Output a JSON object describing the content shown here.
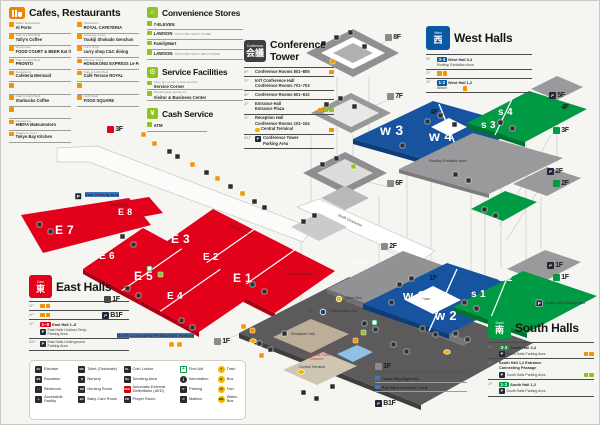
{
  "cafes": {
    "title": "Cafes, Restaurants",
    "floor_tag": "3F",
    "col1": [
      {
        "cat": "Italian Restaurant",
        "name": "Al Porto"
      },
      {
        "cat": "Cafe & Light Meal",
        "name": "Tully's Coffee"
      },
      {
        "cat": "Food Court",
        "name": "FOOD COURT & BEER Eat iT!"
      },
      {
        "cat": "Cafe & Light Meal",
        "name": "PRONTO"
      },
      {
        "cat": "Restaurant",
        "name": "Cafeteria Mermaid"
      },
      {
        "cat": "",
        "name": ""
      },
      {
        "cat": "Cafe & Light Meal",
        "name": "Starbucks Coffee"
      },
      {
        "cat": "",
        "name": ""
      },
      {
        "cat": "Restaurant",
        "name": "HIBIYA Matsumotoro"
      },
      {
        "cat": "Japanese Food",
        "name": "Tokyo Bay Kitchen"
      }
    ],
    "col2": [
      {
        "cat": "Restaurant",
        "name": "ROYAL CAFETERIA"
      },
      {
        "cat": "Japanese Food",
        "name": "Tsukiji Shokado Genchan"
      },
      {
        "cat": "Curry Shop",
        "name": "curry shop C&C dining"
      },
      {
        "cat": "Chinese Food",
        "name": "HONGKONG EXPRESS Le PARC"
      },
      {
        "cat": "Cafe & Light Meal",
        "name": "Café Terrace ROYAL"
      },
      {
        "cat": "",
        "name": ""
      },
      {
        "cat": "Light Meal",
        "name": "FOOD SQUARE"
      }
    ]
  },
  "convenience": {
    "title": "Convenience Stores",
    "items": [
      {
        "name": "7-ELEVEN",
        "note": ""
      },
      {
        "name": "LAWSON",
        "note": "TOKYO BIG SIGHT STORE"
      },
      {
        "name": "FamilyMart",
        "note": ""
      },
      {
        "name": "LAWSON",
        "note": "TOKYO BIG SIGHT WEST STORE"
      }
    ]
  },
  "service": {
    "title": "Service Facilities",
    "items": [
      {
        "note": "Copy, fax, courier & other services",
        "name": "Service Corner"
      },
      {
        "note": "Prepaid cards, goods, etc.",
        "name": "Visitor & Business Center"
      }
    ]
  },
  "cash": {
    "title": "Cash Service",
    "item": "ATM"
  },
  "conference": {
    "tag": "Conference",
    "kanji": "会議",
    "title1": "Conference",
    "title2": "Tower",
    "rows": [
      {
        "floor": "8F",
        "l1": "Conference Rooms 801–805",
        "l2": "",
        "l3": ""
      },
      {
        "floor": "7F",
        "l1": "Int'l Conference Hall",
        "l2": "Conference Rooms 701–703",
        "l3": ""
      },
      {
        "floor": "6F",
        "l1": "Conference Rooms 601–610",
        "l2": "",
        "l3": ""
      },
      {
        "floor": "2F",
        "l1": "Entrance Hall",
        "l2": "Entrance Plaza",
        "l3": ""
      },
      {
        "floor": "1F",
        "l1": "Reception Hall",
        "l2": "Conference Rooms 101–104",
        "l3": "Central Terminal"
      },
      {
        "floor": "B1F",
        "l1": "Conference Tower",
        "l2": "Parking Area",
        "l3": ""
      }
    ]
  },
  "west": {
    "tag": "West",
    "kanji": "西",
    "title": "West Halls",
    "r4": {
      "floor": "4F",
      "num": "3·4",
      "name": "West Hall 3,4",
      "sub": "Rooftop Exhibition Area"
    },
    "r2": {
      "floor": "2F"
    },
    "r1": {
      "floor": "1F",
      "num": "1·2",
      "name": "West Hall 1,2",
      "sub": "Atrium"
    }
  },
  "east": {
    "tag": "East",
    "kanji": "東",
    "title": "East Halls",
    "r3": {
      "floor": "3F"
    },
    "r2": {
      "floor": "2F"
    },
    "r1": {
      "floor": "1F",
      "num": "1–8",
      "name": "East Hall 1–8",
      "sub1": "East Halls Outdoor Temp.",
      "sub2": "Parking Area"
    },
    "rb": {
      "floor": "B1F",
      "sub1": "East Halls Underground",
      "sub2": "Parking Area"
    }
  },
  "south": {
    "tag": "South",
    "kanji": "南",
    "title": "South Halls",
    "r4": {
      "floor": "4F",
      "num": "3·4",
      "name": "South Hall 3,4",
      "sub": "South Halls Parking Area"
    },
    "r2": {
      "floor": "2F",
      "name1": "South Hall 1,2 Entrance",
      "name2": "Connecting Passage",
      "sub": "South Halls Parking Area"
    },
    "r1": {
      "floor": "1F",
      "num": "1·2",
      "name": "South Hall 1,2",
      "sub": "South Halls Parking Area"
    }
  },
  "tenants": {
    "floor": "1F",
    "items": [
      "Tokyo Big Sight Inc.",
      "Big Sight Services Corp."
    ],
    "basement": "B1F"
  },
  "legend": {
    "col1": [
      {
        "l": "Elevator",
        "g": "EV",
        "ic": "k"
      },
      {
        "l": "Escalator",
        "g": "ES",
        "ic": "k"
      },
      {
        "l": "Restroom",
        "g": "♀♂",
        "ic": "k"
      },
      {
        "l": "Accessible Facility",
        "g": "♿",
        "ic": "k"
      }
    ],
    "col2": [
      {
        "l": "Toilet (Ostomate)",
        "g": "WC",
        "ic": "k"
      },
      {
        "l": "Nursery",
        "g": "N",
        "ic": "k"
      },
      {
        "l": "Nursing Room",
        "g": "NR",
        "ic": "k"
      },
      {
        "l": "Baby Care Room",
        "g": "BC",
        "ic": "k"
      }
    ],
    "col3": [
      {
        "l": "Coin Locker",
        "g": "CL",
        "ic": "k"
      },
      {
        "l": "Smoking Area",
        "g": "SA",
        "ic": "k"
      },
      {
        "l": "Automatic External Defibrillator (AED)",
        "g": "AED",
        "ic": "r2"
      },
      {
        "l": "Prayer Room",
        "g": "PR",
        "ic": "k"
      }
    ],
    "col4": [
      {
        "l": "First Aid",
        "g": "+",
        "ic": "fa"
      },
      {
        "l": "Information",
        "g": "i",
        "ic": "kc"
      },
      {
        "l": "Parking",
        "g": "P",
        "ic": "k"
      },
      {
        "l": "Mailbox",
        "g": "✉",
        "ic": "k"
      }
    ],
    "col5": [
      {
        "l": "Train",
        "g": "T",
        "ic": "y"
      },
      {
        "l": "Bus",
        "g": "B",
        "ic": "y"
      },
      {
        "l": "Taxi",
        "g": "TX",
        "ic": "y"
      },
      {
        "l": "Water-Bus",
        "g": "WB",
        "ic": "y"
      }
    ]
  },
  "floor_tags": [
    {
      "t": "8F",
      "x": 384,
      "y": 33,
      "c": "gy"
    },
    {
      "t": "7F",
      "x": 386,
      "y": 92,
      "c": "gy"
    },
    {
      "t": "4F",
      "x": 421,
      "y": 108,
      "c": "bl"
    },
    {
      "t": "6F",
      "x": 386,
      "y": 179,
      "c": "gy"
    },
    {
      "t": "5F",
      "x": 548,
      "y": 91,
      "c": "p"
    },
    {
      "t": "4F",
      "x": 552,
      "y": 103,
      "c": "gn"
    },
    {
      "t": "3F",
      "x": 552,
      "y": 126,
      "c": "gn"
    },
    {
      "t": "2F",
      "x": 546,
      "y": 167,
      "c": "p"
    },
    {
      "t": "2F",
      "x": 552,
      "y": 179,
      "c": "gn"
    },
    {
      "t": "2F",
      "x": 380,
      "y": 242,
      "c": "gy"
    },
    {
      "t": "1F",
      "x": 420,
      "y": 274,
      "c": "bl"
    },
    {
      "t": "1F",
      "x": 546,
      "y": 261,
      "c": "p"
    },
    {
      "t": "1F",
      "x": 552,
      "y": 273,
      "c": "gn"
    },
    {
      "t": "1F",
      "x": 103,
      "y": 295,
      "c": "dk"
    },
    {
      "t": "B1F",
      "x": 101,
      "y": 311,
      "c": "p"
    },
    {
      "t": "1F",
      "x": 213,
      "y": 337,
      "c": "gy"
    },
    {
      "t": "3F",
      "x": 106,
      "y": 125,
      "c": "rd"
    }
  ],
  "map_labels": [
    {
      "t": "East Parking Area",
      "x": 84,
      "y": 191,
      "s": 4,
      "c": "d b"
    },
    {
      "t": "Link Space",
      "x": 110,
      "y": 202,
      "s": 3.4,
      "c": "d"
    },
    {
      "t": "North Concourse",
      "x": 230,
      "y": 222,
      "s": 3.4,
      "c": "d",
      "r": 27
    },
    {
      "t": "South Concourse",
      "x": 338,
      "y": 212,
      "s": 3.4,
      "c": "d",
      "r": 25
    },
    {
      "t": "Rooftop Exhibition Area",
      "x": 428,
      "y": 158,
      "s": 3.6,
      "c": "d"
    },
    {
      "t": "Atrium",
      "x": 419,
      "y": 296,
      "s": 3.6,
      "c": "d"
    },
    {
      "t": "Event plaza",
      "x": 352,
      "y": 259,
      "s": 3.6,
      "c": "w"
    },
    {
      "t": "Entrance Plaza",
      "x": 288,
      "y": 271,
      "s": 3.6,
      "c": "d"
    },
    {
      "t": "Reception Hall",
      "x": 290,
      "y": 331,
      "s": 3.6,
      "c": "d"
    },
    {
      "t": "Conference Tower",
      "x": 302,
      "y": 352,
      "s": 3.4,
      "c": "r"
    },
    {
      "t": "Entrance",
      "x": 309,
      "y": 356,
      "s": 3.4,
      "c": "r"
    },
    {
      "t": "Central Terminal",
      "x": 298,
      "y": 364,
      "s": 3.6,
      "c": "d"
    },
    {
      "t": "Yurikamome Line",
      "x": 328,
      "y": 308,
      "s": 3.6,
      "c": "d"
    },
    {
      "t": "Water Bus",
      "x": 344,
      "y": 295,
      "s": 3.6,
      "c": "d"
    },
    {
      "t": "North Concourse Restaurant Avenue",
      "x": 116,
      "y": 332,
      "s": 4.4,
      "c": "d b"
    },
    {
      "t": "South Halls Parking Area",
      "x": 544,
      "y": 300,
      "s": 3.6,
      "c": "d"
    },
    {
      "t": "E 7",
      "x": 54,
      "y": 222,
      "s": 12,
      "c": "h"
    },
    {
      "t": "E 8",
      "x": 117,
      "y": 206,
      "s": 9,
      "c": "h"
    },
    {
      "t": "E 3",
      "x": 170,
      "y": 231,
      "s": 12,
      "c": "h"
    },
    {
      "t": "E 2",
      "x": 202,
      "y": 251,
      "s": 10,
      "c": "h"
    },
    {
      "t": "E 1",
      "x": 232,
      "y": 270,
      "s": 12,
      "c": "h"
    },
    {
      "t": "E 6",
      "x": 98,
      "y": 250,
      "s": 10,
      "c": "h"
    },
    {
      "t": "E 5",
      "x": 133,
      "y": 268,
      "s": 12,
      "c": "h"
    },
    {
      "t": "E 4",
      "x": 166,
      "y": 290,
      "s": 10,
      "c": "h"
    },
    {
      "t": "w 3",
      "x": 379,
      "y": 121,
      "s": 14,
      "c": "h"
    },
    {
      "t": "w 4",
      "x": 428,
      "y": 127,
      "s": 14,
      "c": "h"
    },
    {
      "t": "w 1",
      "x": 402,
      "y": 287,
      "s": 13,
      "c": "h"
    },
    {
      "t": "w 2",
      "x": 434,
      "y": 307,
      "s": 13,
      "c": "h"
    },
    {
      "t": "s 4",
      "x": 497,
      "y": 106,
      "s": 10,
      "c": "h"
    },
    {
      "t": "s 3",
      "x": 480,
      "y": 119,
      "s": 10,
      "c": "h"
    },
    {
      "t": "s 2",
      "x": 497,
      "y": 272,
      "s": 10,
      "c": "h"
    },
    {
      "t": "s 1",
      "x": 470,
      "y": 288,
      "s": 10,
      "c": "h"
    }
  ]
}
